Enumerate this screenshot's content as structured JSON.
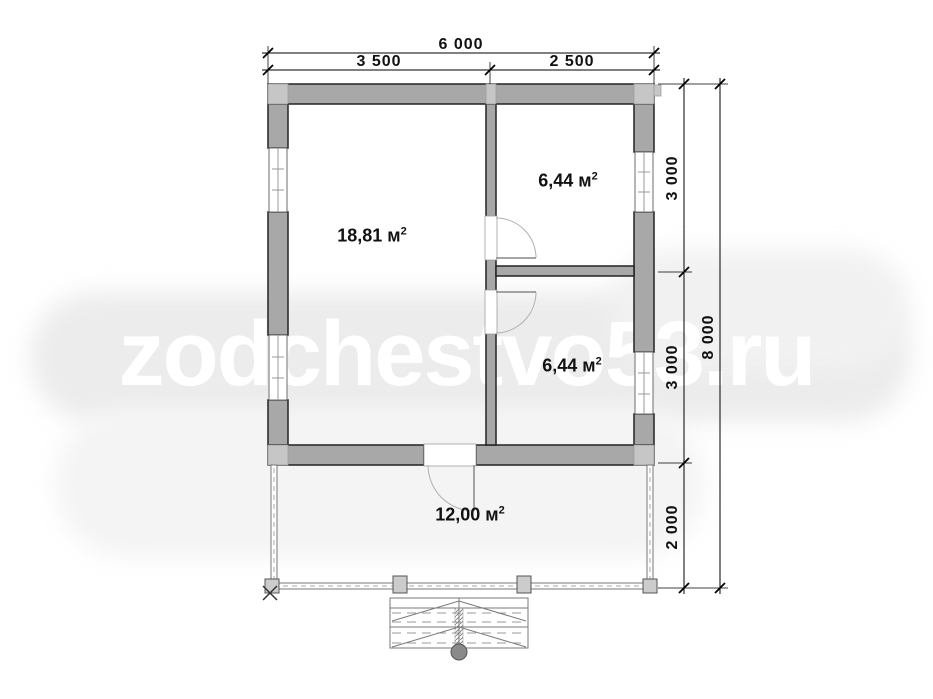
{
  "watermark": "zodchestvo53.ru",
  "units": {
    "area_unit": "м",
    "area_sup": "2"
  },
  "dimensions": {
    "top_total": "6 000",
    "top_left": "3 500",
    "top_right": "2 500",
    "right_upper": "3 000",
    "right_middle": "3 000",
    "right_lower": "2 000",
    "right_total": "8 000"
  },
  "rooms": {
    "living": {
      "area": "18,81"
    },
    "top_right": {
      "area": "6,44"
    },
    "bottom_right": {
      "area": "6,44"
    },
    "terrace": {
      "area": "12,00"
    }
  },
  "colors": {
    "wall_fill": "#a8a8a8",
    "wall_outline": "#222222",
    "corner_block": "#c6c6c6",
    "dim_line": "#000000",
    "door_arc": "#b0b0b0",
    "stairs": "#7a7a7a",
    "watermark_bg": "#ececec",
    "watermark_text": "#ffffff"
  }
}
